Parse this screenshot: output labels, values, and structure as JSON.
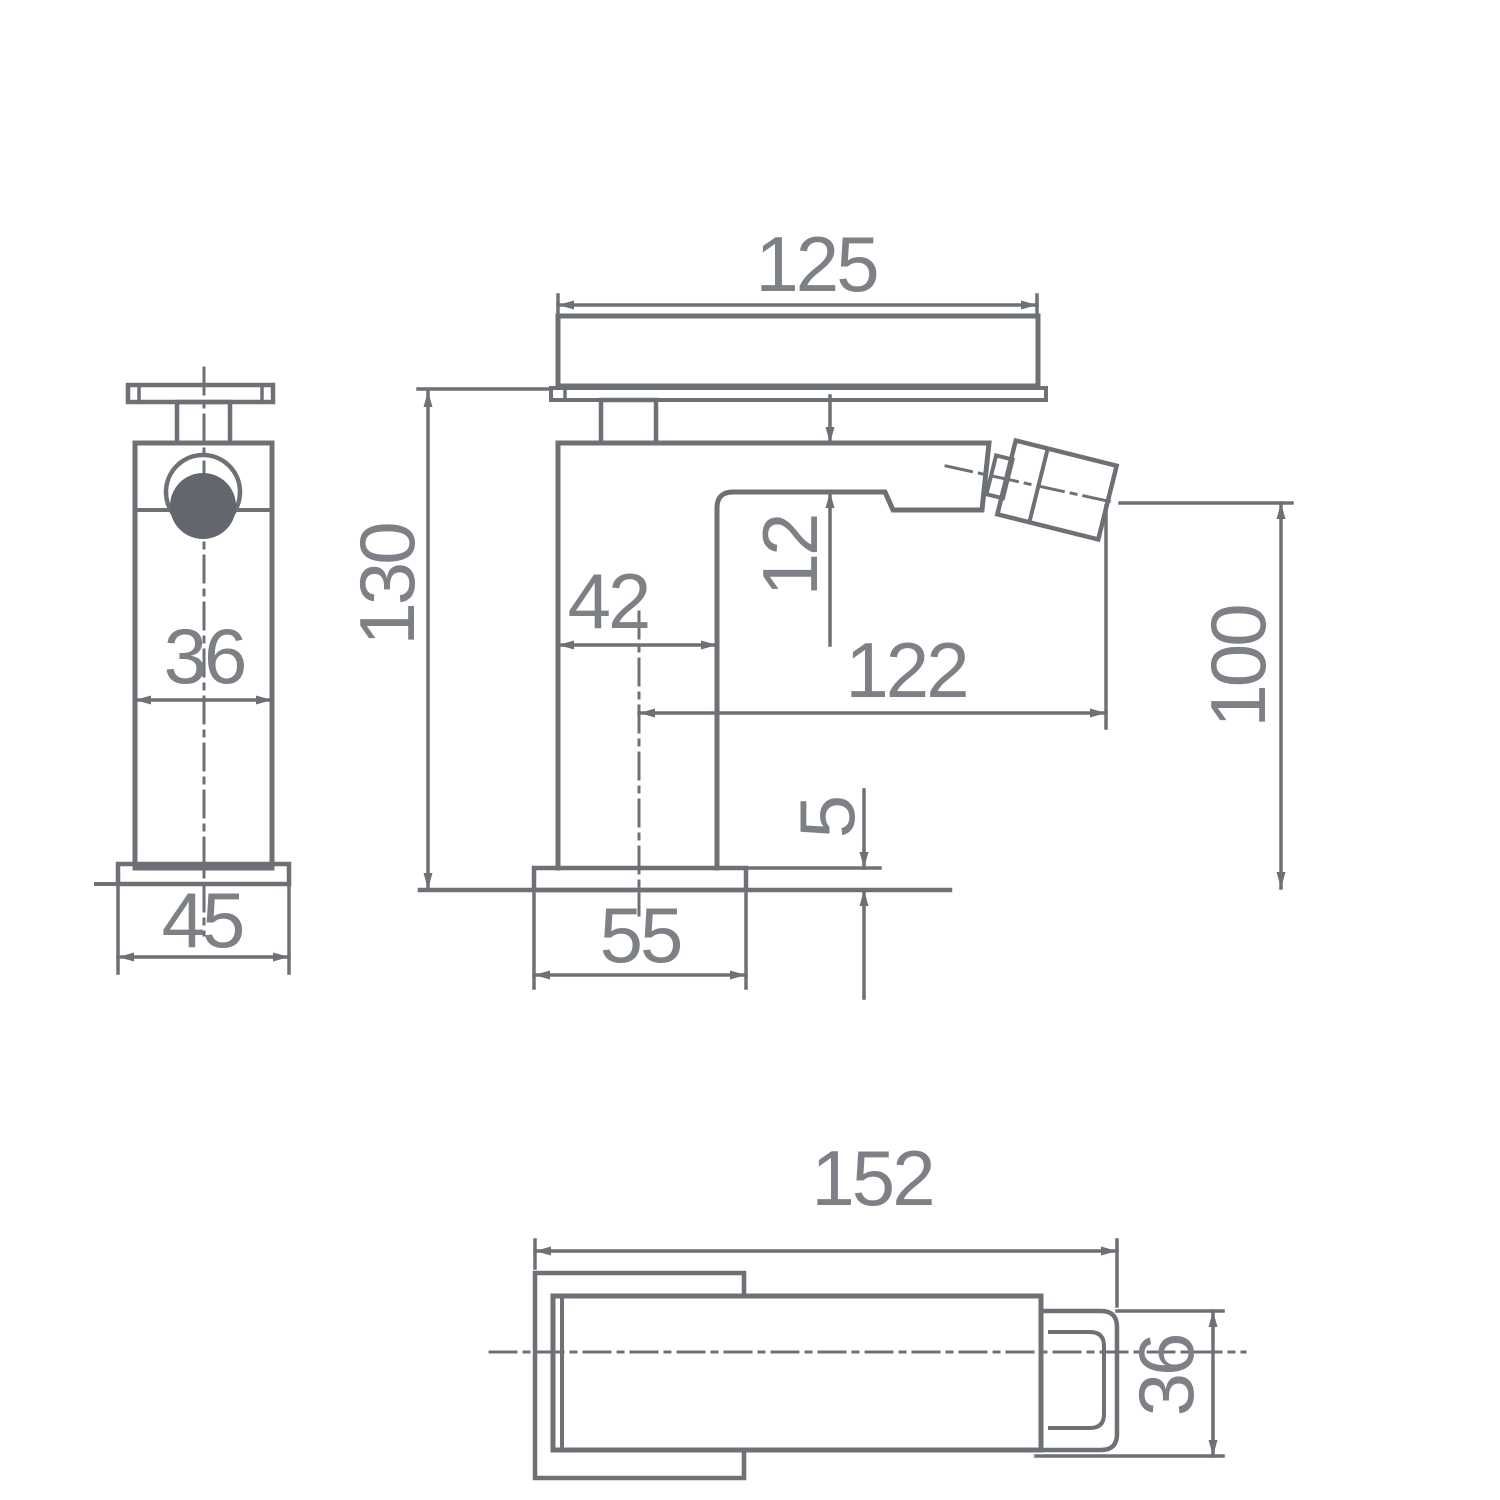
{
  "drawing": {
    "type": "technical-dimension-drawing",
    "subject": "square single-lever faucet (bidet mixer) with three orthographic views",
    "units": "mm",
    "colors": {
      "background": "#ffffff",
      "line": "#6d7176",
      "text": "#7d8186",
      "solid_fill": "#63676d"
    },
    "views": {
      "side": {
        "label": "side view",
        "dims": {
          "body_width": "36",
          "base_width": "45"
        }
      },
      "front": {
        "label": "front view",
        "dims": {
          "handle_length": "125",
          "overall_height": "130",
          "body_depth": "42",
          "spout_offset": "12",
          "spout_reach": "122",
          "spout_height": "100",
          "base_thickness": "5",
          "base_length": "55"
        }
      },
      "plan": {
        "label": "plan view",
        "dims": {
          "overall_length": "152",
          "end_width": "36"
        }
      }
    }
  }
}
